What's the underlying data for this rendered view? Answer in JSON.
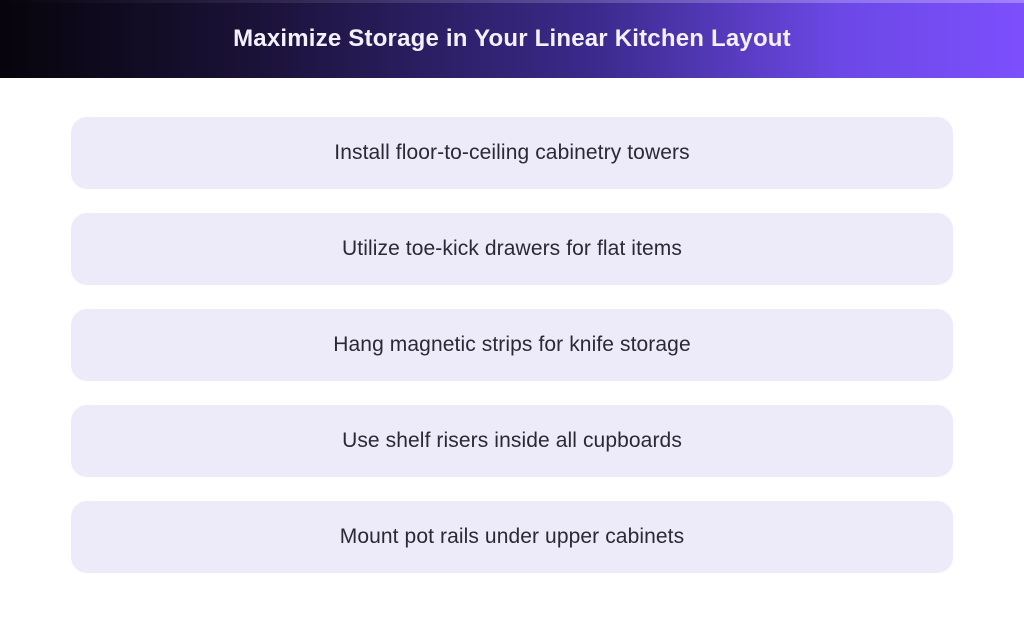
{
  "header": {
    "title": "Maximize Storage in Your Linear Kitchen Layout"
  },
  "cards": {
    "items": [
      {
        "label": "Install floor-to-ceiling cabinetry towers"
      },
      {
        "label": "Utilize toe-kick drawers for flat items"
      },
      {
        "label": "Hang magnetic strips for knife storage"
      },
      {
        "label": "Use shelf risers inside all cupboards"
      },
      {
        "label": "Mount pot rails under upper cabinets"
      }
    ]
  },
  "theme": {
    "header_gradient_start": "#07040c",
    "header_gradient_end": "#7c4ffc",
    "header_title_color": "#f4f1fc",
    "card_background": "#edeafa",
    "card_text_color": "#2b2933",
    "page_background": "#ffffff"
  }
}
